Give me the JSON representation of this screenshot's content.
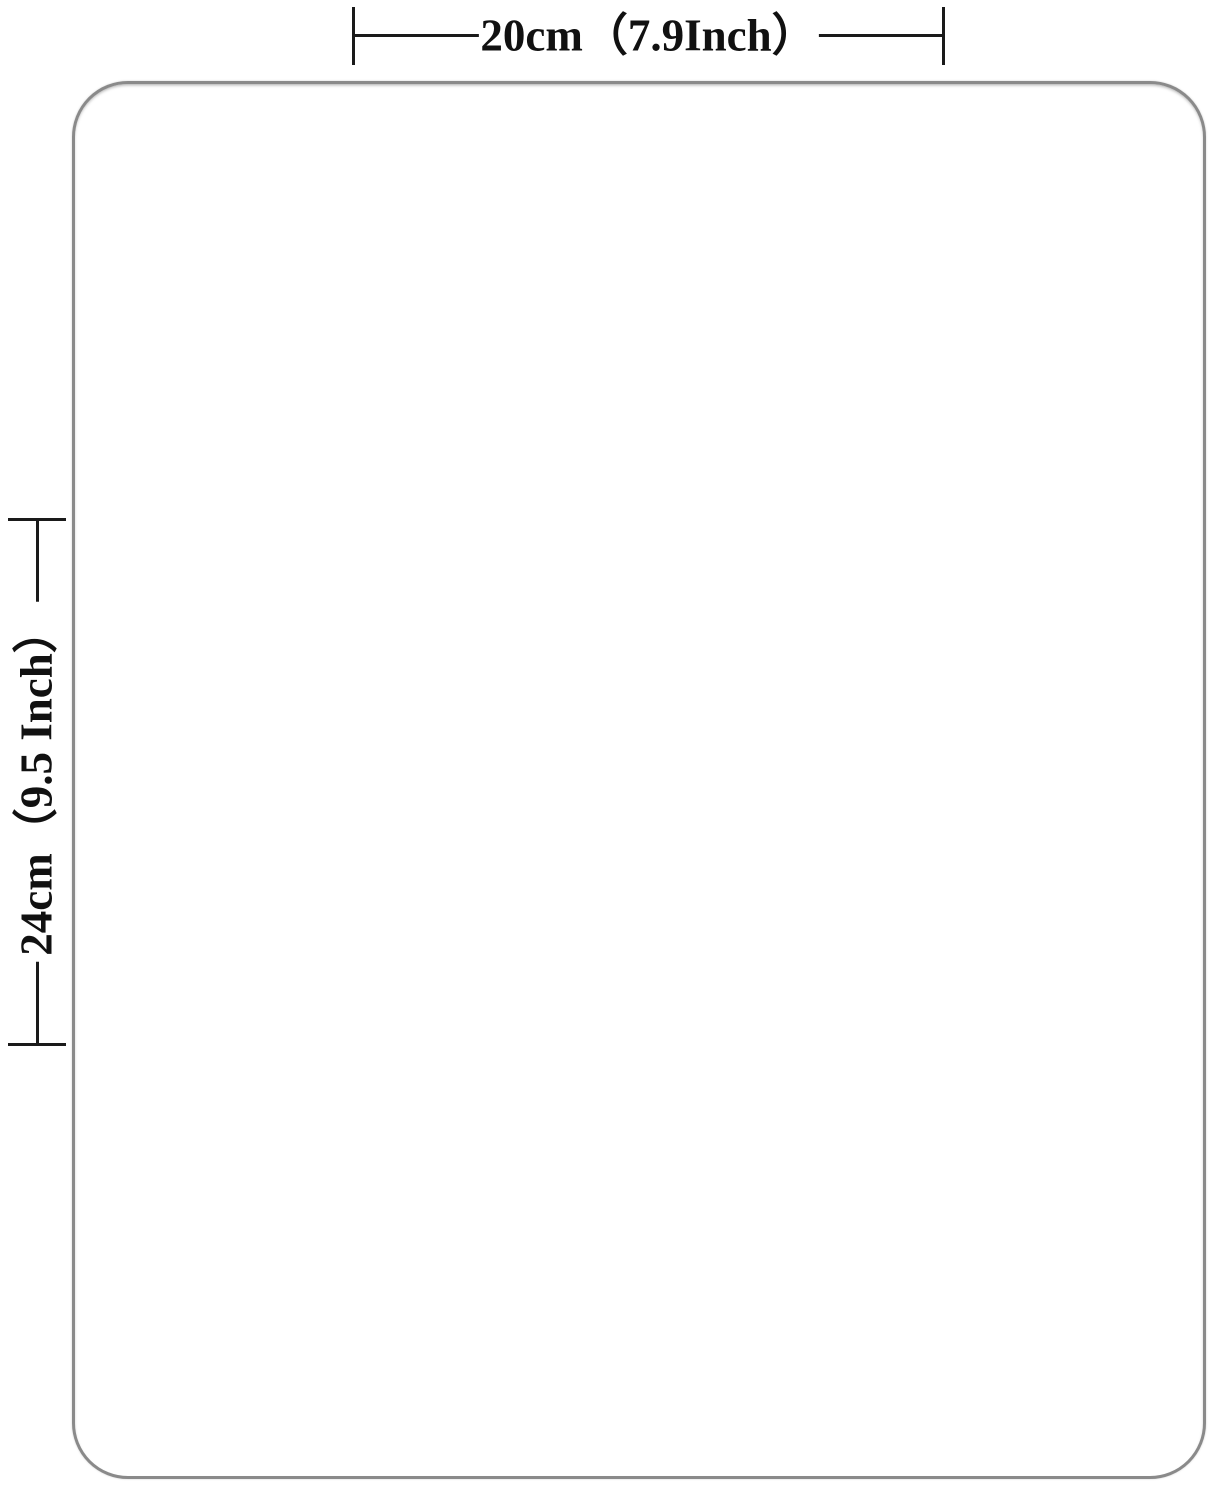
{
  "diagram": {
    "title": "product-size-diagram",
    "top_dimension": {
      "label": "20cm（7.9Inch）"
    },
    "left_dimension": {
      "label": "24cm（9.5 Inch）"
    },
    "colors": {
      "background": "#ffffff",
      "card_fill": "#ffffff",
      "card_border": "#8a8a8a",
      "dimension_line": "#1a1a1a",
      "label_text": "#111111"
    }
  }
}
